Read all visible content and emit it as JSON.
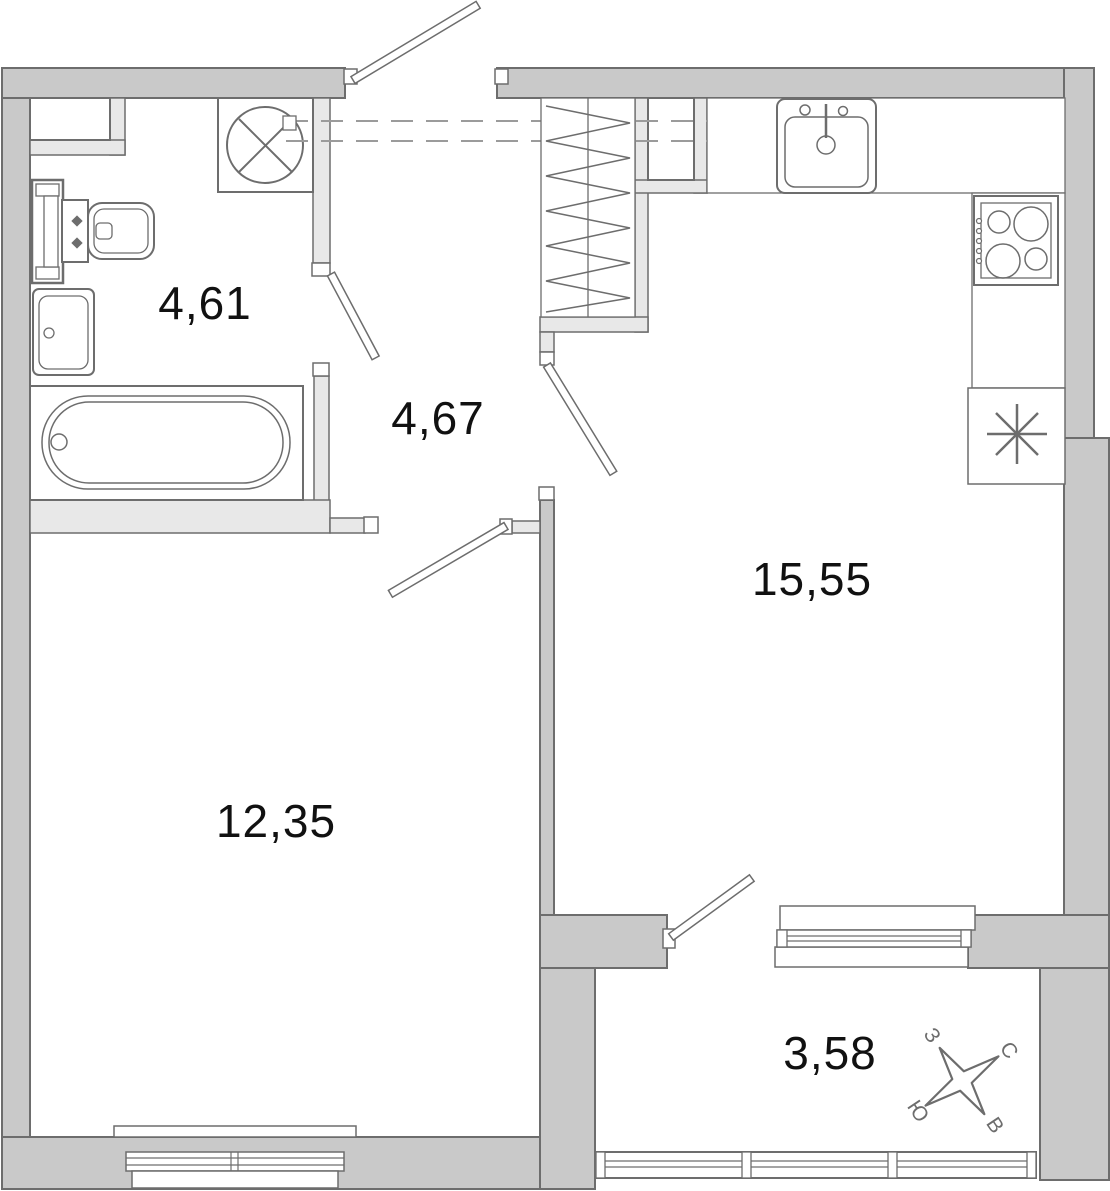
{
  "title": "Apartment floor plan",
  "rooms": [
    {
      "name": "bathroom",
      "area": "4,61"
    },
    {
      "name": "hallway",
      "area": "4,67"
    },
    {
      "name": "kitchen-living-room",
      "area": "15,55"
    },
    {
      "name": "room",
      "area": "12,35"
    },
    {
      "name": "balcony",
      "area": "3,58"
    }
  ],
  "compass": {
    "north": "С",
    "south": "Ю",
    "east": "В",
    "west": "З"
  },
  "fixtures": [
    "bathtub",
    "washbasin",
    "toilet",
    "towel-radiator",
    "washing-machine",
    "wardrobe",
    "duct-shaft",
    "kitchen-sink",
    "stove",
    "fridge"
  ],
  "colors": {
    "exterior_wall": "#c9c9c9",
    "interior_wall": "#e8e8e8",
    "outline": "#6d6d6d",
    "dashed_line": "#9b9b9b",
    "label_text": "#111111"
  }
}
